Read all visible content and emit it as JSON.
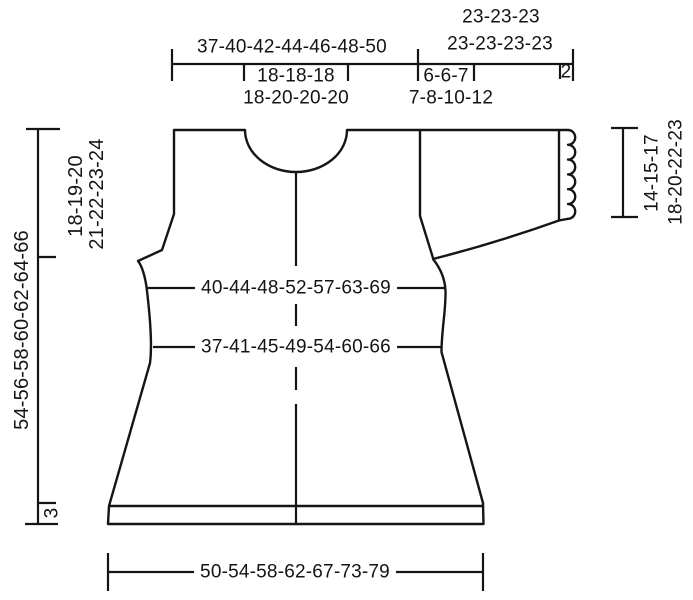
{
  "measurements": {
    "top": {
      "body_width": "37-40-42-44-46-48-50",
      "neck_row1": "18-18-18",
      "neck_row2": "18-20-20-20",
      "sleeve_row1": "23-23-23",
      "sleeve_row2": "23-23-23-23",
      "shoulder_row1": "6-6-7",
      "shoulder_row2": "7-8-10-12",
      "cuff_edge": "2"
    },
    "left": {
      "yoke_depth_row1": "18-19-20",
      "yoke_depth_row2": "21-22-23-24",
      "total_length": "54-56-58-60-62-64-66",
      "hem_band": "3"
    },
    "right": {
      "sleeve_length_row1": "14-15-17",
      "sleeve_length_row2": "18-20-22-23"
    },
    "body": {
      "bust_width": "40-44-48-52-57-63-69",
      "waist_width": "37-41-45-49-54-60-66"
    },
    "bottom": {
      "hem_width": "50-54-58-62-67-73-79"
    }
  },
  "colors": {
    "line": "#151515",
    "background": "#ffffff"
  }
}
